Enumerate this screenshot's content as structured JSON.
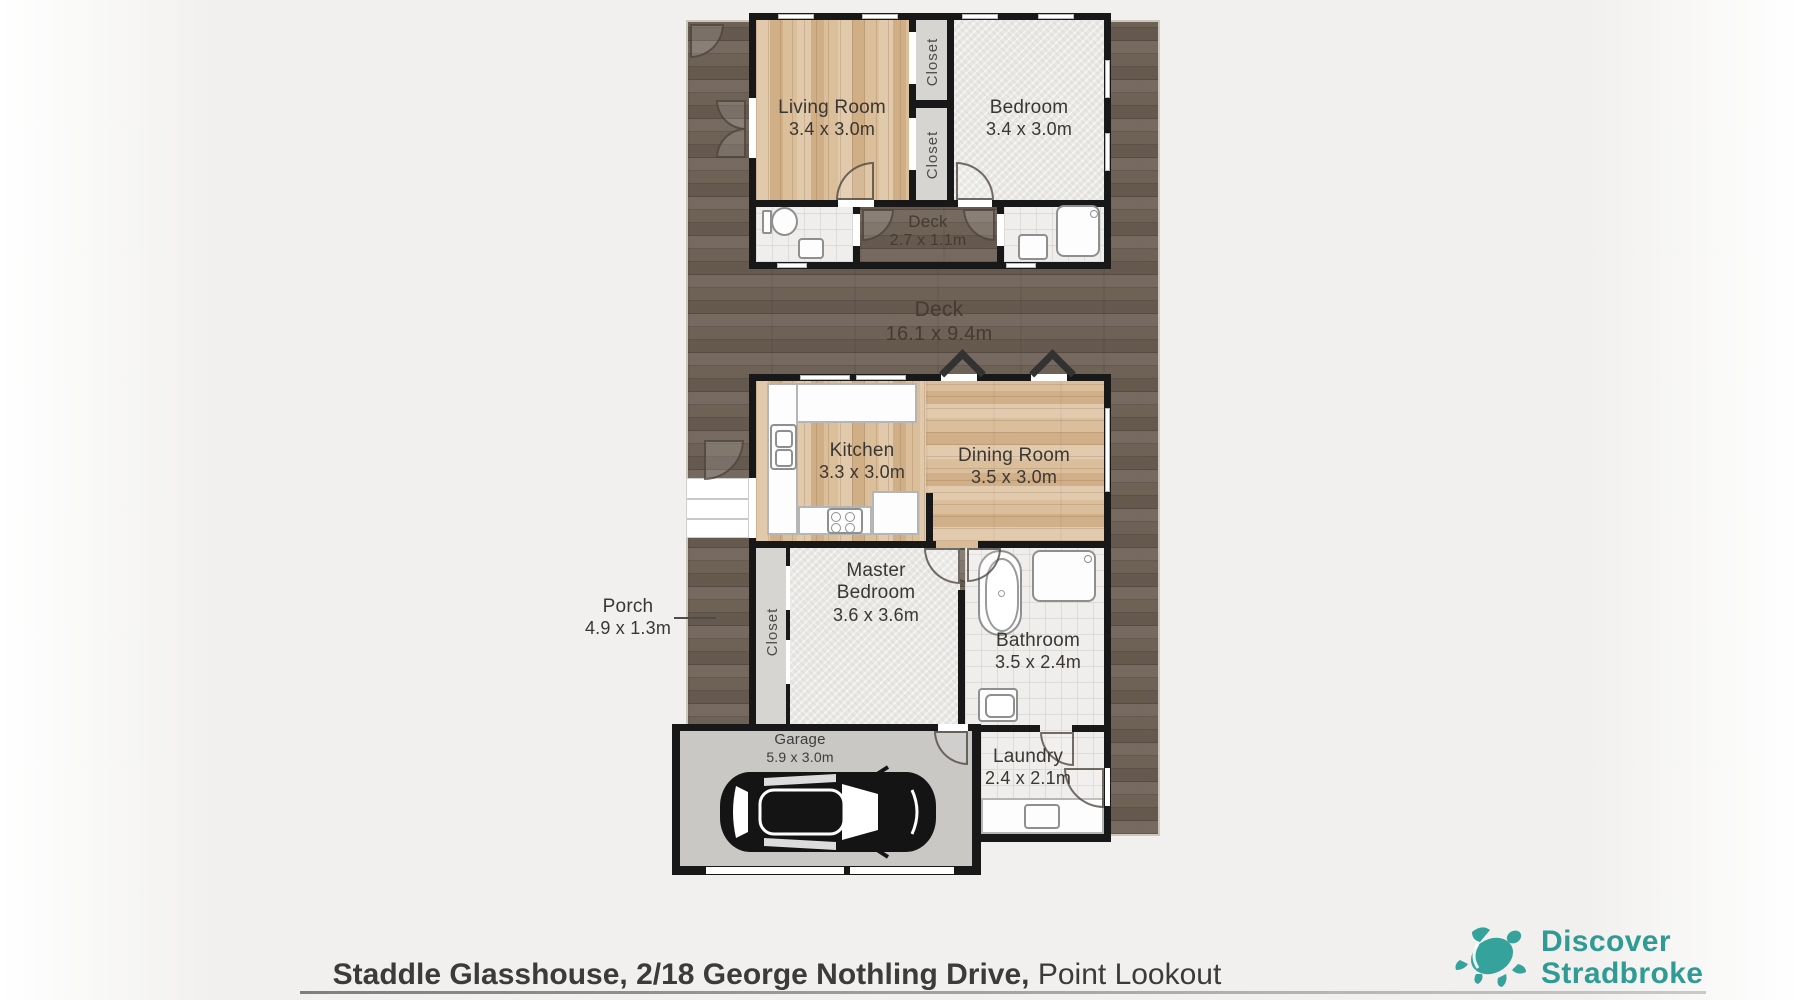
{
  "plan": {
    "rooms": {
      "living": {
        "name": "Living Room",
        "dims": "3.4 x 3.0m"
      },
      "bedroom": {
        "name": "Bedroom",
        "dims": "3.4 x 3.0m"
      },
      "closet_top": {
        "name": "Closet"
      },
      "closet_bottom": {
        "name": "Closet"
      },
      "deck_small": {
        "name": "Deck",
        "dims": "2.7 x 1.1m"
      },
      "deck_main": {
        "name": "Deck",
        "dims": "16.1 x 9.4m"
      },
      "kitchen": {
        "name": "Kitchen",
        "dims": "3.3 x 3.0m"
      },
      "dining": {
        "name": "Dining Room",
        "dims": "3.5 x 3.0m"
      },
      "porch": {
        "name": "Porch",
        "dims": "4.9 x 1.3m"
      },
      "closet_master": {
        "name": "Closet"
      },
      "master": {
        "name_line1": "Master",
        "name_line2": "Bedroom",
        "dims": "3.6 x 3.6m"
      },
      "bathroom": {
        "name": "Bathroom",
        "dims": "3.5 x 2.4m"
      },
      "laundry": {
        "name": "Laundry",
        "dims": "2.4 x 2.1m"
      },
      "garage": {
        "name": "Garage",
        "dims": "5.9 x 3.0m"
      }
    }
  },
  "footer": {
    "address_bold": "Staddle Glasshouse, 2/18 George Nothling Drive,",
    "address_regular": " Point Lookout"
  },
  "logo": {
    "line1": "Discover",
    "line2": "Stradbroke"
  },
  "colors": {
    "brand_teal": "#2f9b94",
    "deck_wood": "#6e6156",
    "light_wood": "#d9bb97",
    "wall": "#181818"
  }
}
